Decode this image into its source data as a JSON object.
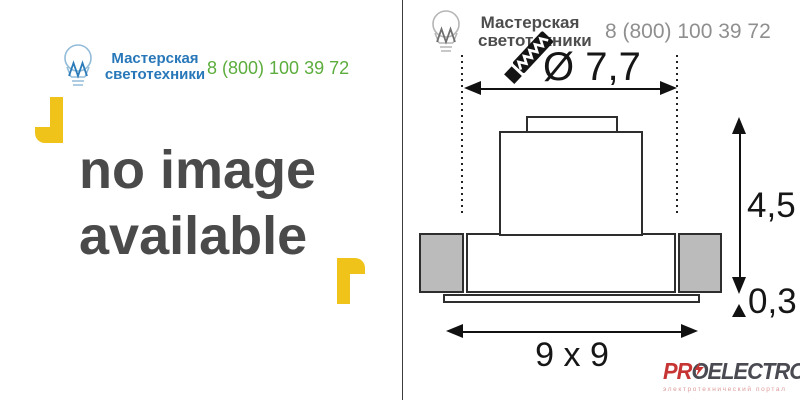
{
  "brand": {
    "name_line1": "Мастерская",
    "name_line2": "светотехники",
    "phone": "8 (800) 100 39 72",
    "name_color": "#2878B9",
    "phone_color": "#5CAD3D",
    "bulb_icon": "lightbulb-icon"
  },
  "placeholder": {
    "line1": "no image",
    "line2": "available",
    "text_color": "#4A4A4A",
    "bracket_color": "#EFC319"
  },
  "watermark": {
    "name_color": "#4D4D4D",
    "phone_color": "#8F8F8F",
    "saw_icon": "saw-icon"
  },
  "diagram": {
    "diameter_label": "Ø 7,7",
    "height_label": "4,5",
    "plate_label": "0,3",
    "base_label": "9 x 9",
    "line_color": "#161616",
    "section_fill": "#BBBBBB"
  },
  "footer_logo": {
    "part_pr": "PR",
    "part_o": "O",
    "part_electro": "ELECTRO",
    "part_ru": "RU",
    "subtitle": "электротехнический портал",
    "red": "#C63434",
    "dark": "#4A4A52",
    "bolt_icon": "lightning-bolt-icon"
  }
}
